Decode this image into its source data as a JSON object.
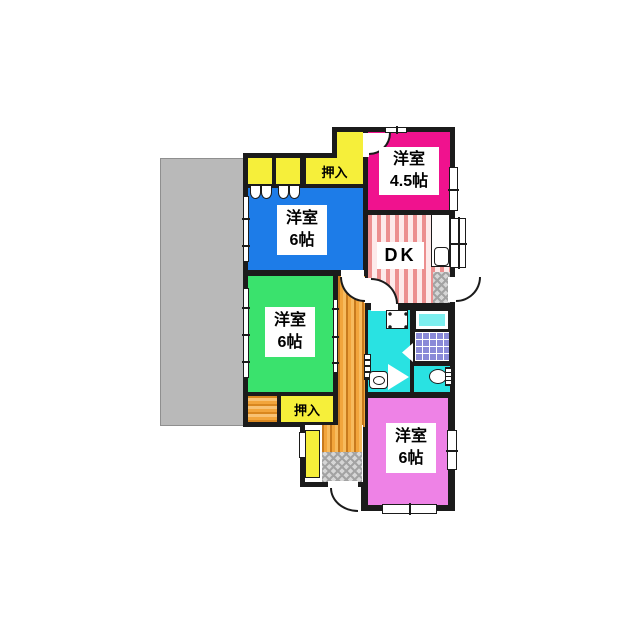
{
  "plan_title": "floor-plan",
  "colors": {
    "wall": "#1b1b1b",
    "room_blue": "#1d7ce8",
    "room_green": "#3ae26d",
    "room_magenta": "#f0128e",
    "room_violet": "#ee82e6",
    "room_yellow": "#f6ef3a",
    "room_cyan": "#29e2e2",
    "bathtub": "#7ceeee",
    "tile": "#8a8ad8",
    "corridor": "#f2a53c",
    "dk_stripe": "#ec8f8f",
    "gray_area": "#b9b9b9"
  },
  "rooms": {
    "bedroom_nw": {
      "name": "洋室",
      "size": "6帖"
    },
    "bedroom_ne": {
      "name": "洋室",
      "size": "4.5帖"
    },
    "bedroom_w": {
      "name": "洋室",
      "size": "6帖"
    },
    "bedroom_s": {
      "name": "洋室",
      "size": "6帖"
    },
    "dining_kitchen": {
      "label": "DK"
    }
  },
  "closets": {
    "top": {
      "label": "押入"
    },
    "bottom": {
      "label": "押入"
    }
  }
}
